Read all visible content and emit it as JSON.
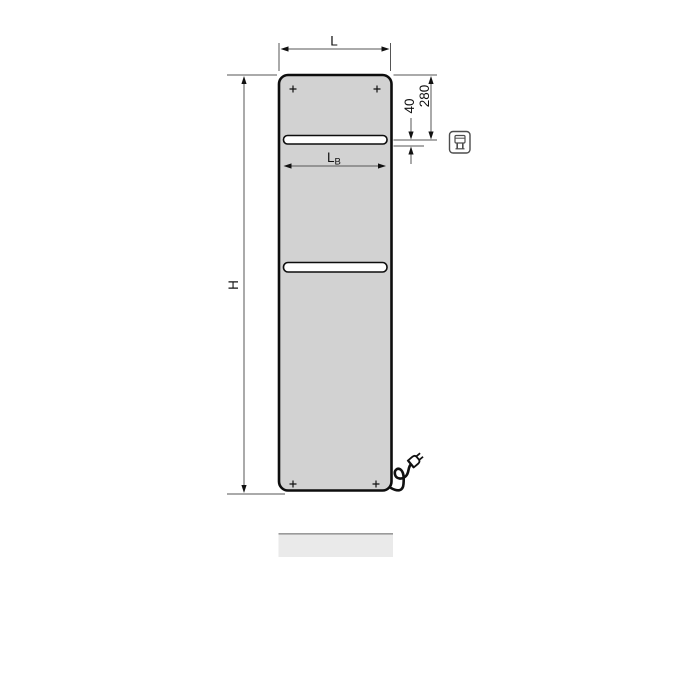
{
  "diagram": {
    "type": "technical-dimension-drawing",
    "subject": "flat electric panel radiator, front view, with towel slots, power cable with plug and floor shadow",
    "labels": {
      "overall_width": "L",
      "overall_height": "H",
      "inner_width_main": "L",
      "inner_width_sub": "B",
      "top_to_slot": "280",
      "slot_gap": "40"
    },
    "icons": [
      {
        "name": "electric-plug-icon",
        "meaning": "electric connection / plug-in operation"
      }
    ],
    "colors": {
      "panel_fill": "#d2d2d2",
      "panel_border": "#0d0d0d",
      "slot_fill": "#ffffff",
      "dimension_line": "#555555",
      "arrow_and_text": "#111111",
      "shadow_fill": "#eaeaea",
      "shadow_edge": "#9b9b9b",
      "icon_stroke": "#4d4d4d"
    }
  }
}
